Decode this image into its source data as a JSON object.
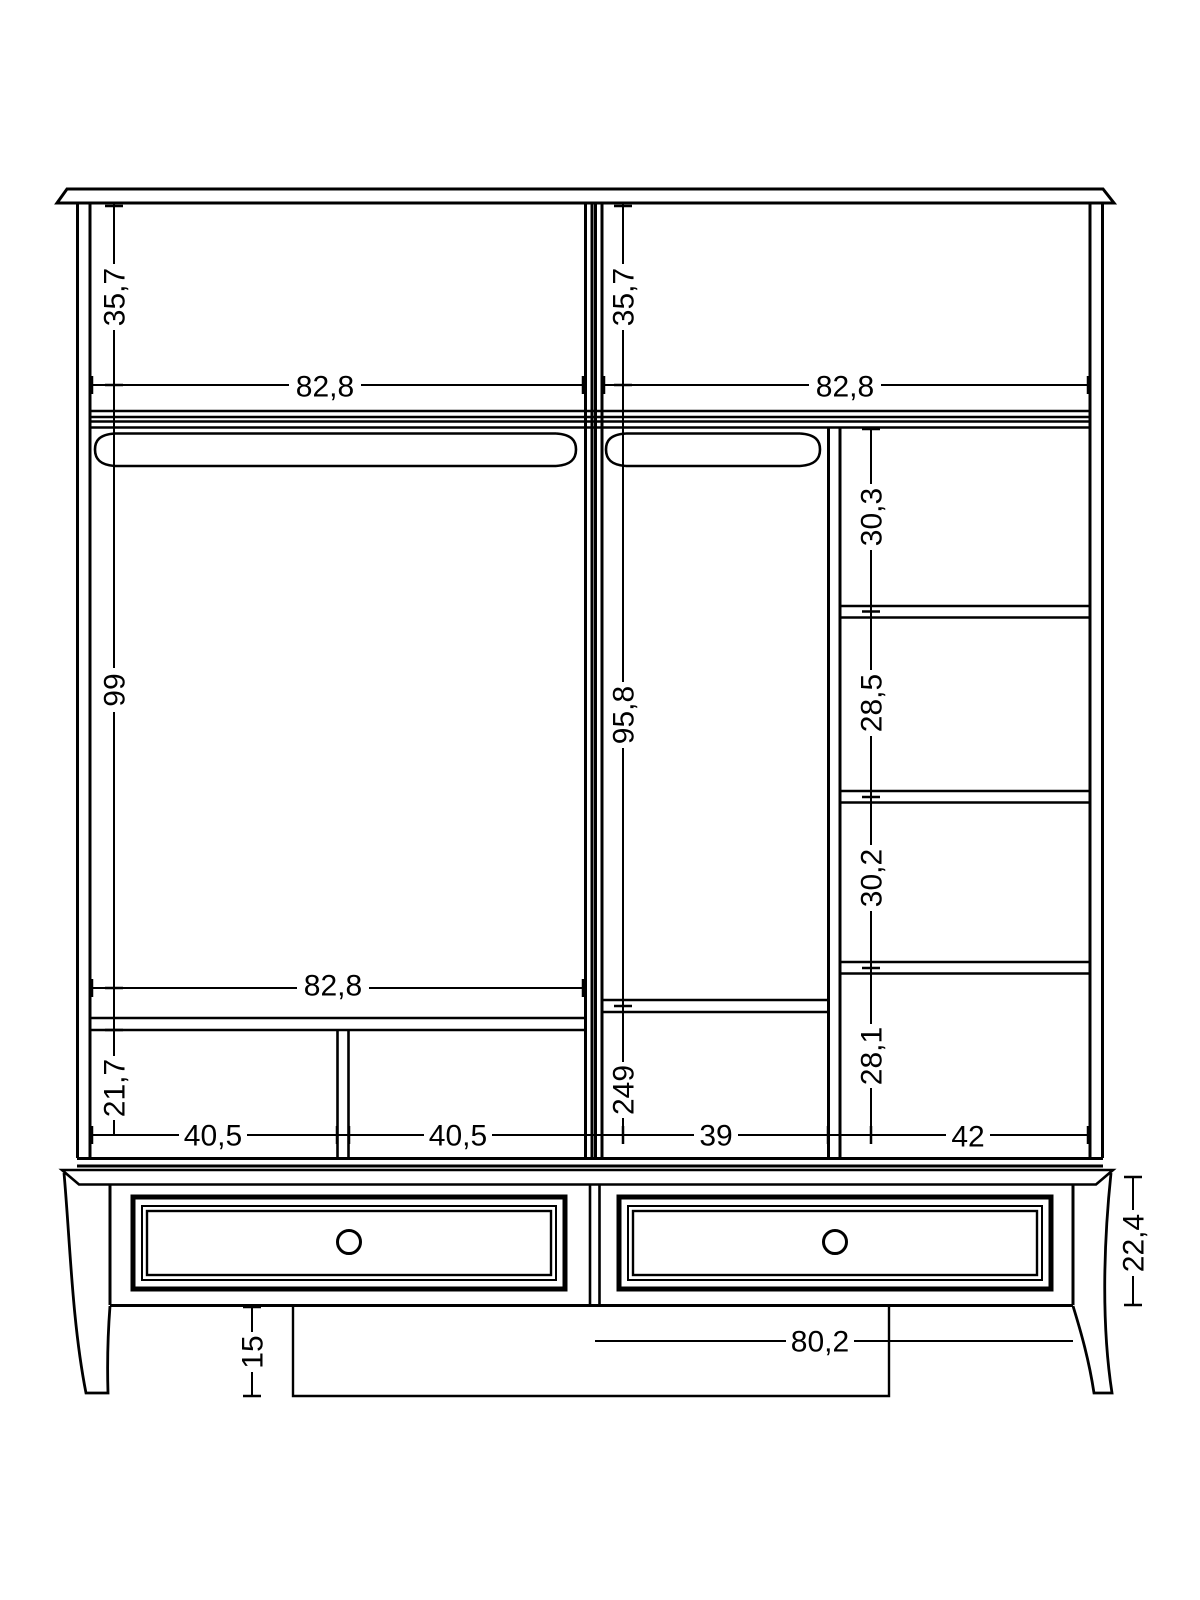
{
  "colors": {
    "line": "#000000",
    "background": "#ffffff",
    "text": "#000000"
  },
  "dimensions": [
    {
      "id": "left-top-section-height",
      "value": "35,7"
    },
    {
      "id": "left-top-width",
      "value": "82,8"
    },
    {
      "id": "right-top-section-height",
      "value": "35,7"
    },
    {
      "id": "right-top-width",
      "value": "82,8"
    },
    {
      "id": "left-hanging-height",
      "value": "99"
    },
    {
      "id": "middle-hanging-height",
      "value": "95,8"
    },
    {
      "id": "shelf-column-space-1",
      "value": "30,3"
    },
    {
      "id": "shelf-column-space-2",
      "value": "28,5"
    },
    {
      "id": "shelf-column-space-3",
      "value": "30,2"
    },
    {
      "id": "left-mid-width",
      "value": "82,8"
    },
    {
      "id": "left-bottom-space-height",
      "value": "21,7"
    },
    {
      "id": "middle-bottom-space-height",
      "value": "249"
    },
    {
      "id": "shelf-column-space-4",
      "value": "28,1"
    },
    {
      "id": "left-bottom-width-a",
      "value": "40,5"
    },
    {
      "id": "left-bottom-width-b",
      "value": "40,5"
    },
    {
      "id": "middle-bottom-width",
      "value": "39"
    },
    {
      "id": "shelf-column-width",
      "value": "42"
    },
    {
      "id": "base-height",
      "value": "22,4"
    },
    {
      "id": "leg-height",
      "value": "15"
    },
    {
      "id": "drawer-width",
      "value": "80,2"
    }
  ]
}
